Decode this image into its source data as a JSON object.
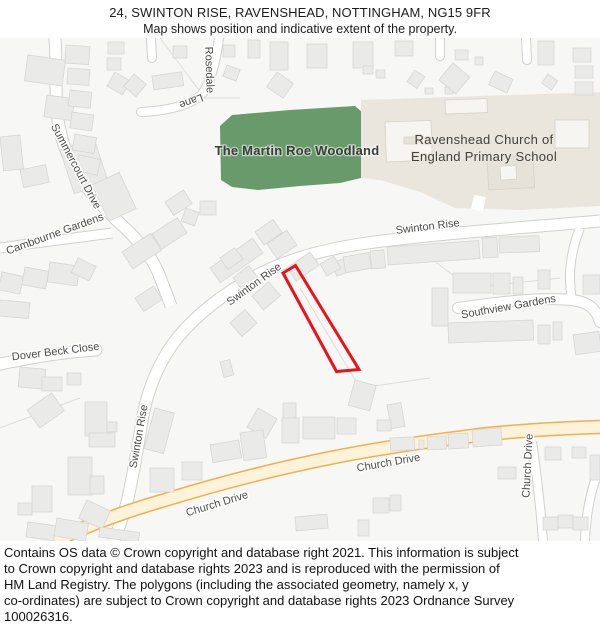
{
  "header": {
    "title": "24, SWINTON RISE, RAVENSHEAD, NOTTINGHAM, NG15 9FR",
    "subtitle": "Map shows position and indicative extent of the property."
  },
  "map": {
    "areas": {
      "woodland_label": "The Martin Roe Woodland",
      "school_label_line1": "Ravenshead Church of",
      "school_label_line2": "England Primary School"
    },
    "roads": {
      "swinton_rise": "Swinton Rise",
      "southview_gardens": "Southview Gardens",
      "dover_beck_close": "Dover Beck Close",
      "cambourne_gardens": "Cambourne Gardens",
      "summercourt_drive": "Summercourt Drive",
      "rosedale": "Rosedale",
      "lane": "Lane",
      "church_drive": "Church Drive"
    },
    "property": {
      "outline_color": "#e8131b"
    },
    "colors": {
      "woodland_fill": "#689a6b",
      "school_fill": "#ebe6dd",
      "church_drive_casing": "#eeb14a",
      "church_drive_fill": "#fdf3da",
      "map_background": "#f7f7f5"
    }
  },
  "footer": {
    "lines": [
      "Contains OS data © Crown copyright and database right 2021. This information is subject",
      "to Crown copyright and database rights 2023 and is reproduced with the permission of",
      "HM Land Registry. The polygons (including the associated geometry, namely x, y",
      "co-ordinates) are subject to Crown copyright and database rights 2023 Ordnance Survey",
      "100026316."
    ]
  }
}
